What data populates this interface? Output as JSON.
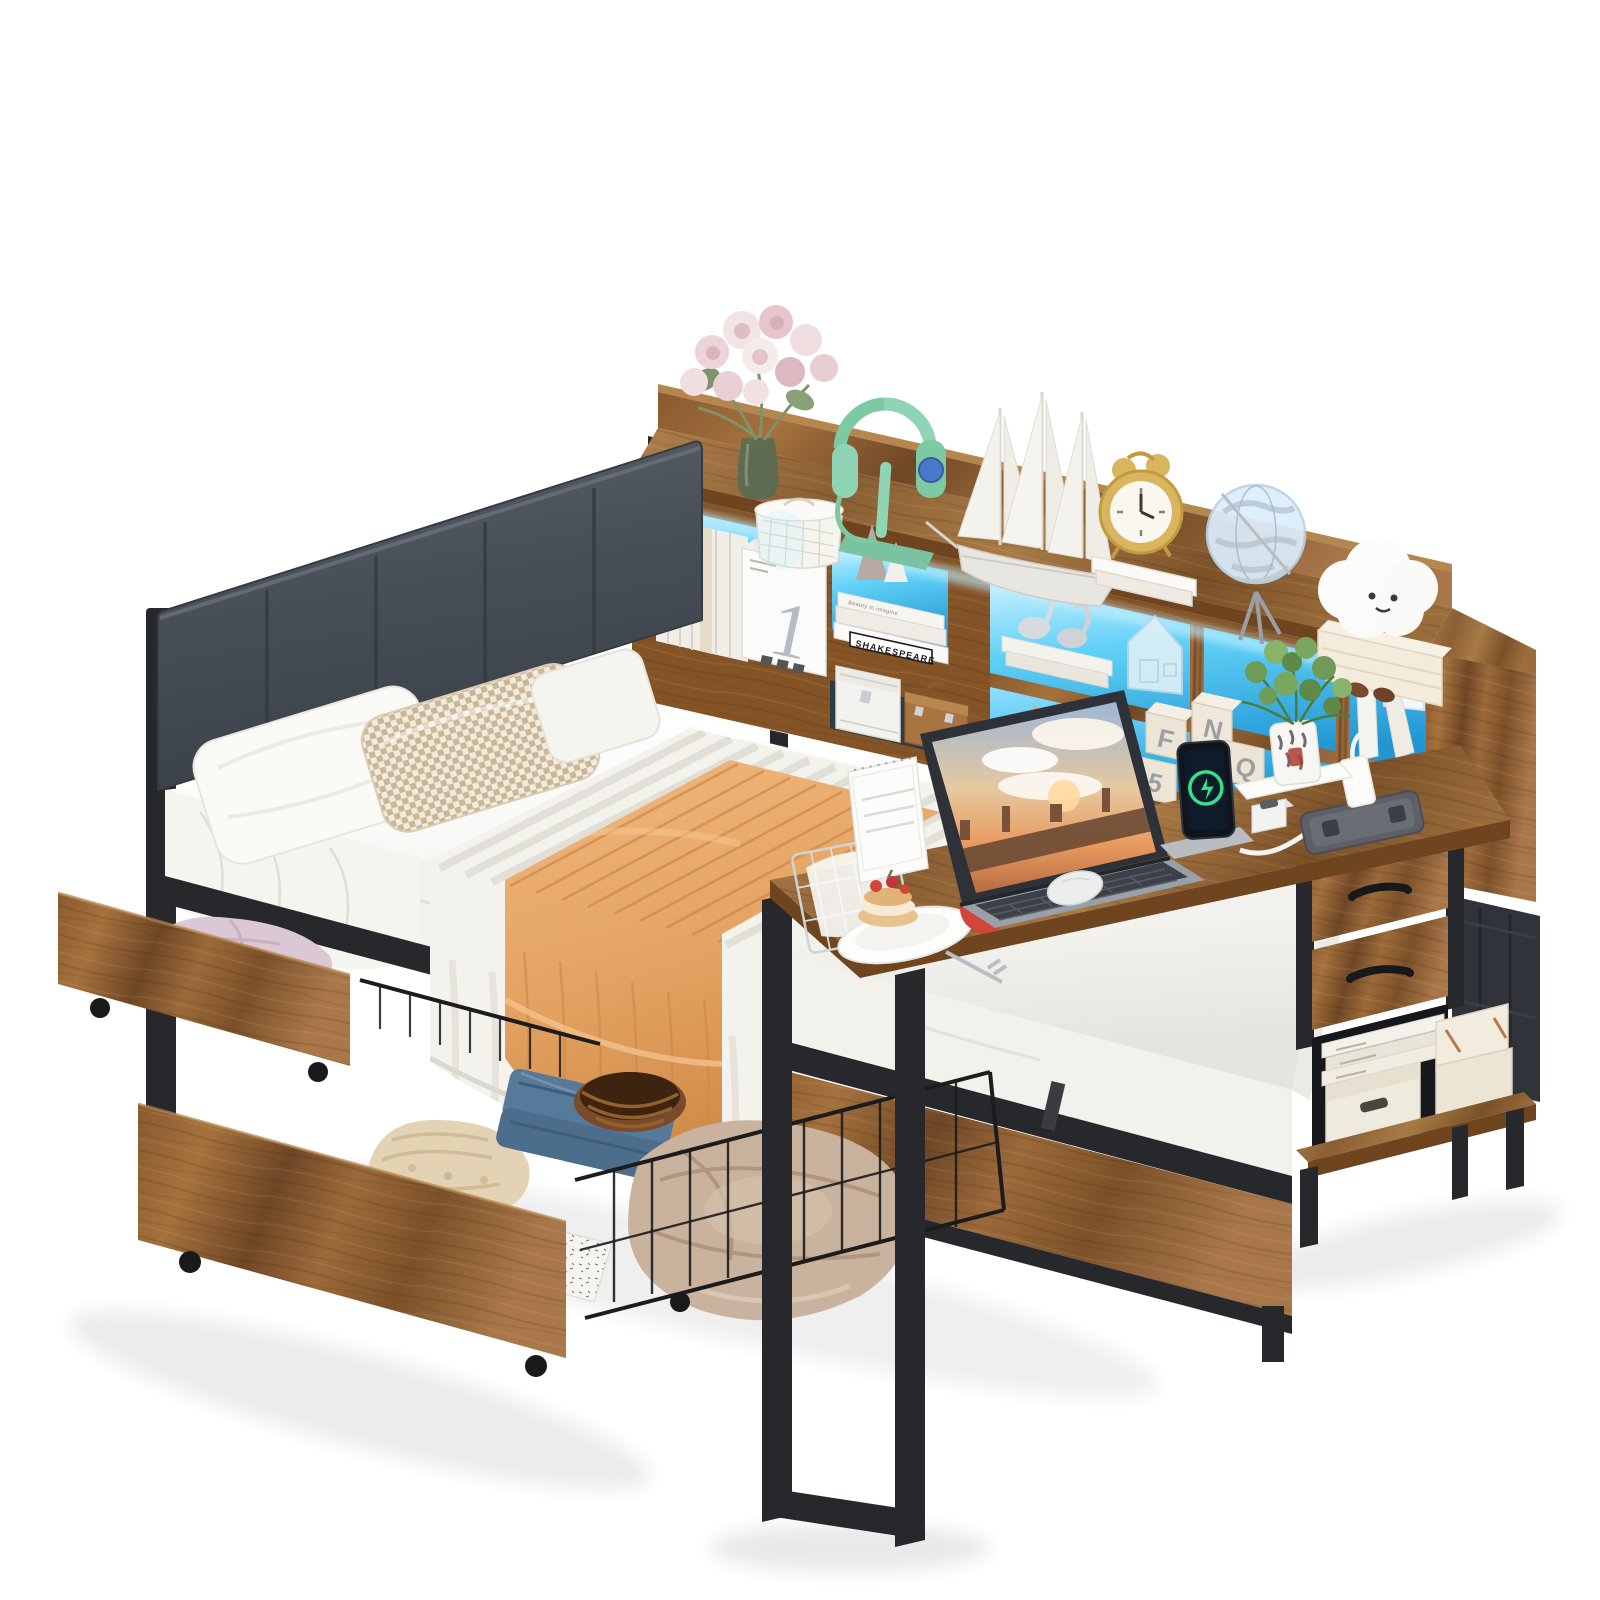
{
  "palette": {
    "bg": "#ffffff",
    "wood": "#9a6a3a",
    "wood-dark": "#6e451f",
    "wood-mid": "#845427",
    "wood-light": "#b5874f",
    "metal": "#26282b",
    "metal-2": "#3a3c40",
    "led": "#4cc5f1",
    "led-deep": "#1f9cd9",
    "led-pale": "#bfeeff",
    "headboard": "#4b515a",
    "headboard-dark": "#3a4047",
    "mattress": "#f6f5f2",
    "sheet-shadow": "#dedbd4",
    "quilt": "#e6a566",
    "quilt-dark": "#cd8748",
    "pillow-tan": "#c9b795",
    "mint": "#8fd4b4",
    "fabric-dark": "#30343a",
    "cream": "#efe9dc",
    "denim": "#587a9a",
    "plant-green": "#6f9b57",
    "charge-green": "#35e08a",
    "apple-red": "#d2453b",
    "shadow": "#3c3c3c"
  },
  "texts": {
    "book_quote": "Beauty to imagine",
    "book_spine": "SHAKESPEARE",
    "box_number": "1",
    "blocks_label": "BLOCKS",
    "letter_blocks": [
      "F",
      "N",
      "5",
      "0",
      "Q"
    ]
  }
}
